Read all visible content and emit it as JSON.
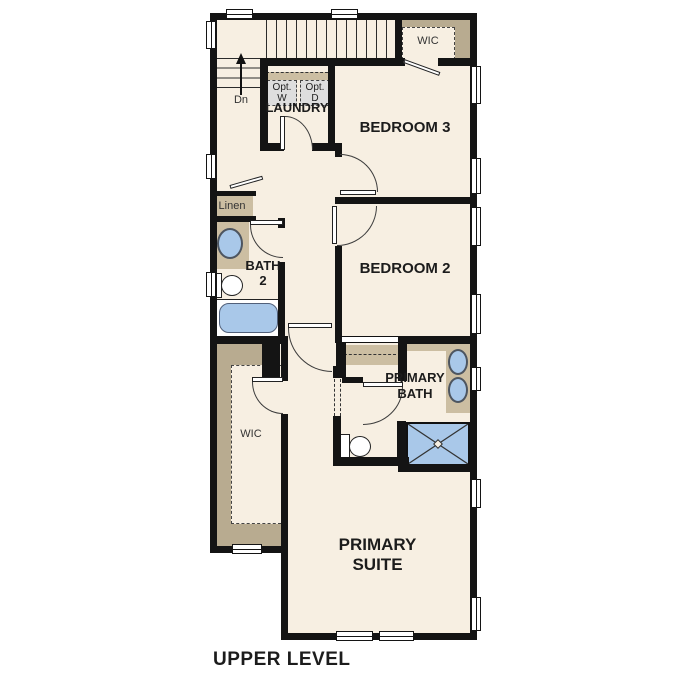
{
  "footer": {
    "title": "UPPER LEVEL"
  },
  "colors": {
    "floor": "#f7efe2",
    "counter": "#ccbea2",
    "shelf": "#b8ab90",
    "wall": "#141414",
    "fixture_blue": "#a9c8e9",
    "appliance_gray": "#dedede"
  },
  "rooms": {
    "bedroom3": {
      "name": "BEDROOM 3"
    },
    "bedroom2": {
      "name": "BEDROOM 2"
    },
    "primary_suite": {
      "line1": "PRIMARY",
      "line2": "SUITE"
    },
    "primary_bath": {
      "line1": "PRIMARY",
      "line2": "BATH"
    },
    "bath2": {
      "line1": "BATH",
      "line2": "2"
    },
    "laundry": {
      "name": "LAUNDRY"
    },
    "wic_bedroom3": {
      "name": "WIC"
    },
    "wic_primary": {
      "name": "WIC"
    },
    "linen": {
      "name": "Linen"
    }
  },
  "stairs": {
    "down_label": "Dn"
  },
  "appliances": {
    "washer_line1": "Opt.",
    "washer_line2": "W",
    "dryer_line1": "Opt.",
    "dryer_line2": "D"
  }
}
